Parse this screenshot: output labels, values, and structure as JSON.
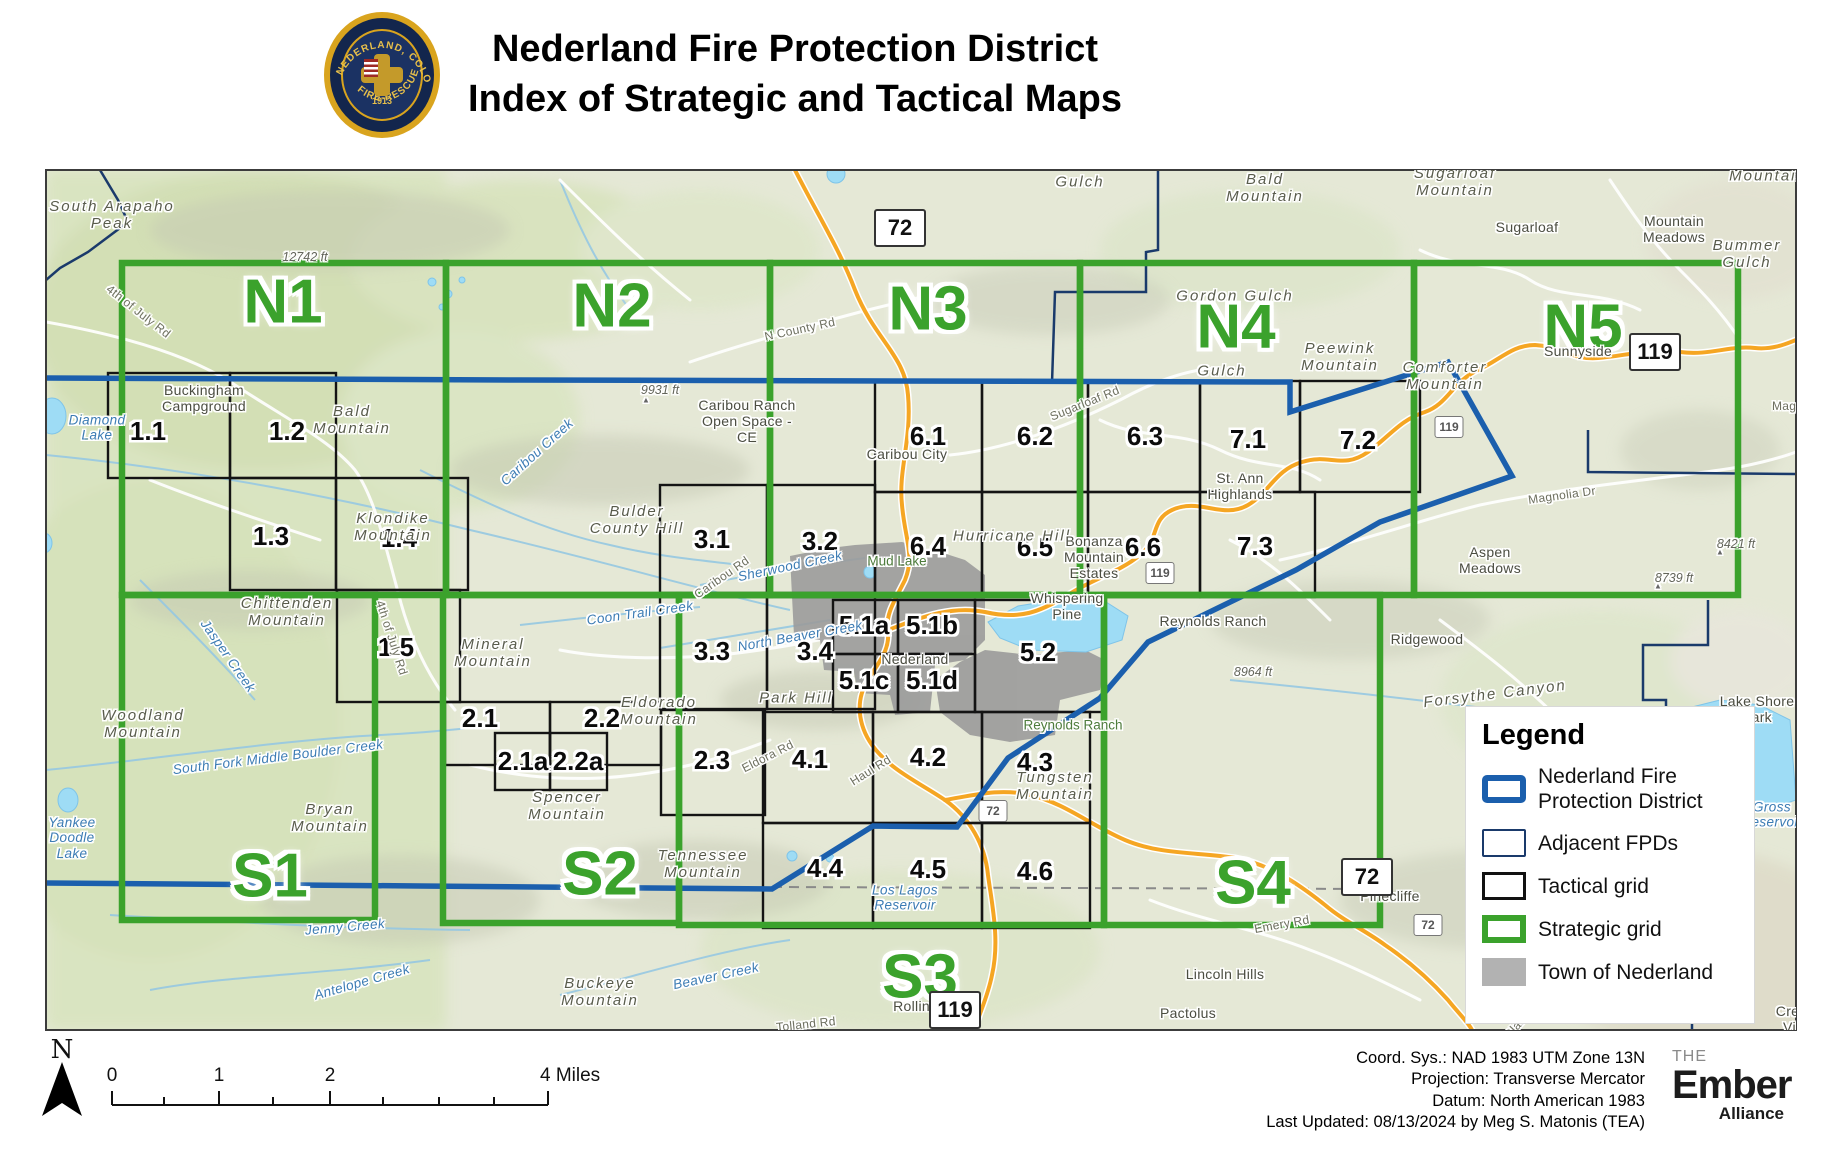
{
  "header": {
    "title_line1": "Nederland Fire Protection District",
    "title_line2": "Index of Strategic and Tactical Maps",
    "logo": {
      "ring_top": "NEDERLAND, COLORADO",
      "ring_bottom": "FIRE-RESCUE",
      "year": "1913"
    }
  },
  "map": {
    "strategic_cells": [
      {
        "id": "N1",
        "x1": 122,
        "y1": 263,
        "x2": 446,
        "y2": 595,
        "lx": 283,
        "ly": 303
      },
      {
        "id": "N2",
        "x1": 446,
        "y1": 263,
        "x2": 770,
        "y2": 595,
        "lx": 612,
        "ly": 307
      },
      {
        "id": "N3",
        "x1": 770,
        "y1": 263,
        "x2": 1080,
        "y2": 595,
        "lx": 928,
        "ly": 310
      },
      {
        "id": "N4",
        "x1": 1080,
        "y1": 263,
        "x2": 1414,
        "y2": 595,
        "lx": 1236,
        "ly": 328
      },
      {
        "id": "N5",
        "x1": 1414,
        "y1": 263,
        "x2": 1738,
        "y2": 595,
        "lx": 1583,
        "ly": 328
      },
      {
        "id": "S1",
        "x1": 122,
        "y1": 595,
        "x2": 375,
        "y2": 920,
        "lx": 270,
        "ly": 877
      },
      {
        "id": "S2",
        "x1": 443,
        "y1": 595,
        "x2": 679,
        "y2": 923,
        "lx": 600,
        "ly": 875
      },
      {
        "id": "S3",
        "x1": 679,
        "y1": 595,
        "x2": 1104,
        "y2": 925,
        "lx": 920,
        "ly": 978
      },
      {
        "id": "S4",
        "x1": 1104,
        "y1": 595,
        "x2": 1380,
        "y2": 925,
        "lx": 1253,
        "ly": 884
      }
    ],
    "tactical_cells": [
      {
        "id": "1.1",
        "x1": 108,
        "y1": 373,
        "x2": 230,
        "y2": 478,
        "lx": 148,
        "ly": 432
      },
      {
        "id": "1.2",
        "x1": 230,
        "y1": 373,
        "x2": 336,
        "y2": 478,
        "lx": 287,
        "ly": 432
      },
      {
        "id": "1.3",
        "x1": 230,
        "y1": 478,
        "x2": 336,
        "y2": 590,
        "lx": 271,
        "ly": 537
      },
      {
        "id": "1.4",
        "x1": 336,
        "y1": 478,
        "x2": 468,
        "y2": 590,
        "lx": 399,
        "ly": 539
      },
      {
        "id": "1.5",
        "x1": 337,
        "y1": 590,
        "x2": 460,
        "y2": 702,
        "lx": 396,
        "ly": 648
      },
      {
        "id": "2.1",
        "x1": 445,
        "y1": 702,
        "x2": 550,
        "y2": 765,
        "lx": 480,
        "ly": 719
      },
      {
        "id": "2.2",
        "x1": 550,
        "y1": 702,
        "x2": 661,
        "y2": 765,
        "lx": 602,
        "ly": 719
      },
      {
        "id": "2.1a",
        "x1": 495,
        "y1": 733,
        "x2": 550,
        "y2": 790,
        "lx": 523,
        "ly": 762
      },
      {
        "id": "2.2a",
        "x1": 550,
        "y1": 733,
        "x2": 607,
        "y2": 790,
        "lx": 578,
        "ly": 762
      },
      {
        "id": "2.3",
        "x1": 661,
        "y1": 710,
        "x2": 765,
        "y2": 815,
        "lx": 712,
        "ly": 761
      },
      {
        "id": "3.1",
        "x1": 660,
        "y1": 485,
        "x2": 767,
        "y2": 593,
        "lx": 712,
        "ly": 540
      },
      {
        "id": "3.2",
        "x1": 767,
        "y1": 485,
        "x2": 875,
        "y2": 593,
        "lx": 820,
        "ly": 542
      },
      {
        "id": "3.3",
        "x1": 660,
        "y1": 597,
        "x2": 767,
        "y2": 709,
        "lx": 712,
        "ly": 652
      },
      {
        "id": "3.4",
        "x1": 767,
        "y1": 597,
        "x2": 875,
        "y2": 709,
        "lx": 815,
        "ly": 652
      },
      {
        "id": "5.1a",
        "x1": 833,
        "y1": 600,
        "x2": 898,
        "y2": 654,
        "lx": 864,
        "ly": 626
      },
      {
        "id": "5.1b",
        "x1": 898,
        "y1": 600,
        "x2": 975,
        "y2": 654,
        "lx": 932,
        "ly": 626
      },
      {
        "id": "5.1c",
        "x1": 833,
        "y1": 654,
        "x2": 898,
        "y2": 712,
        "lx": 864,
        "ly": 681
      },
      {
        "id": "5.1d",
        "x1": 898,
        "y1": 654,
        "x2": 975,
        "y2": 712,
        "lx": 932,
        "ly": 681
      },
      {
        "id": "5.2",
        "x1": 975,
        "y1": 600,
        "x2": 1105,
        "y2": 712,
        "lx": 1038,
        "ly": 653
      },
      {
        "id": "4.1",
        "x1": 763,
        "y1": 712,
        "x2": 873,
        "y2": 823,
        "lx": 810,
        "ly": 760
      },
      {
        "id": "4.2",
        "x1": 873,
        "y1": 712,
        "x2": 982,
        "y2": 823,
        "lx": 928,
        "ly": 758
      },
      {
        "id": "4.3",
        "x1": 982,
        "y1": 712,
        "x2": 1090,
        "y2": 823,
        "lx": 1035,
        "ly": 763
      },
      {
        "id": "4.4",
        "x1": 763,
        "y1": 823,
        "x2": 873,
        "y2": 928,
        "lx": 825,
        "ly": 869
      },
      {
        "id": "4.5",
        "x1": 873,
        "y1": 823,
        "x2": 982,
        "y2": 928,
        "lx": 928,
        "ly": 870
      },
      {
        "id": "4.6",
        "x1": 982,
        "y1": 823,
        "x2": 1090,
        "y2": 928,
        "lx": 1035,
        "ly": 872
      },
      {
        "id": "6.1",
        "x1": 875,
        "y1": 381,
        "x2": 982,
        "y2": 492,
        "lx": 928,
        "ly": 437
      },
      {
        "id": "6.2",
        "x1": 982,
        "y1": 381,
        "x2": 1088,
        "y2": 492,
        "lx": 1035,
        "ly": 437
      },
      {
        "id": "6.3",
        "x1": 1088,
        "y1": 381,
        "x2": 1200,
        "y2": 492,
        "lx": 1145,
        "ly": 437
      },
      {
        "id": "7.1",
        "x1": 1200,
        "y1": 381,
        "x2": 1300,
        "y2": 492,
        "lx": 1248,
        "ly": 440
      },
      {
        "id": "7.2",
        "x1": 1300,
        "y1": 381,
        "x2": 1420,
        "y2": 492,
        "lx": 1358,
        "ly": 441
      },
      {
        "id": "6.4",
        "x1": 875,
        "y1": 492,
        "x2": 982,
        "y2": 597,
        "lx": 928,
        "ly": 547
      },
      {
        "id": "6.5",
        "x1": 982,
        "y1": 492,
        "x2": 1088,
        "y2": 597,
        "lx": 1035,
        "ly": 548
      },
      {
        "id": "6.6",
        "x1": 1088,
        "y1": 492,
        "x2": 1200,
        "y2": 597,
        "lx": 1143,
        "ly": 548
      },
      {
        "id": "7.3",
        "x1": 1200,
        "y1": 492,
        "x2": 1315,
        "y2": 597,
        "lx": 1255,
        "ly": 547
      }
    ],
    "labels": [
      {
        "t": "South Arapaho\nPeak",
        "x": 112,
        "y": 215,
        "c": "peak"
      },
      {
        "t": "12742 ft",
        "x": 305,
        "y": 257,
        "c": "elev"
      },
      {
        "t": "4th of July Rd",
        "x": 138,
        "y": 312,
        "c": "road",
        "r": 38
      },
      {
        "t": "Diamond\nLake",
        "x": 97,
        "y": 428,
        "c": "water"
      },
      {
        "t": "Buckingham\nCampground",
        "x": 204,
        "y": 399,
        "c": "place"
      },
      {
        "t": "Bald\nMountain",
        "x": 352,
        "y": 420,
        "c": "peak"
      },
      {
        "t": "Klondike\nMountain",
        "x": 393,
        "y": 527,
        "c": "peak"
      },
      {
        "t": "Chittenden\nMountain",
        "x": 287,
        "y": 612,
        "c": "peak"
      },
      {
        "t": "Jasper Creek",
        "x": 228,
        "y": 656,
        "c": "water",
        "r": 55
      },
      {
        "t": "Woodland\nMountain",
        "x": 143,
        "y": 724,
        "c": "peak"
      },
      {
        "t": "South Fork Middle Boulder Creek",
        "x": 278,
        "y": 757,
        "c": "water",
        "r": -7
      },
      {
        "t": "Bryan\nMountain",
        "x": 330,
        "y": 818,
        "c": "peak"
      },
      {
        "t": "Yankee\nDoodle\nLake",
        "x": 72,
        "y": 838,
        "c": "water"
      },
      {
        "t": "Jenny Creek",
        "x": 345,
        "y": 927,
        "c": "water",
        "r": -5
      },
      {
        "t": "Antelope Creek",
        "x": 362,
        "y": 982,
        "c": "water",
        "r": -16
      },
      {
        "t": "Mineral\nMountain",
        "x": 493,
        "y": 653,
        "c": "peak"
      },
      {
        "t": "Caribou Creek",
        "x": 537,
        "y": 452,
        "c": "water",
        "r": -42
      },
      {
        "t": "9931 ft",
        "x": 660,
        "y": 390,
        "c": "elev"
      },
      {
        "t": "▲",
        "x": 646,
        "y": 400,
        "c": "tri"
      },
      {
        "t": "Caribou Ranch\nOpen Space -\nCE",
        "x": 747,
        "y": 422,
        "c": "place"
      },
      {
        "t": "N County Rd",
        "x": 800,
        "y": 330,
        "c": "road",
        "r": -12
      },
      {
        "t": "Bulder\nCounty Hill",
        "x": 637,
        "y": 520,
        "c": "peak"
      },
      {
        "t": "Caribou Rd",
        "x": 722,
        "y": 578,
        "c": "road",
        "r": -35
      },
      {
        "t": "Sherwood Creek",
        "x": 790,
        "y": 566,
        "c": "water",
        "r": -12
      },
      {
        "t": "Coon Trail Creek",
        "x": 640,
        "y": 613,
        "c": "water",
        "r": -8
      },
      {
        "t": "Eldorado\nMountain",
        "x": 659,
        "y": 711,
        "c": "peak"
      },
      {
        "t": "Spencer\nMountain",
        "x": 567,
        "y": 806,
        "c": "peak"
      },
      {
        "t": "Tennessee\nMountain",
        "x": 703,
        "y": 864,
        "c": "peak"
      },
      {
        "t": "Buckeye\nMountain",
        "x": 600,
        "y": 992,
        "c": "peak"
      },
      {
        "t": "Beaver Creek",
        "x": 716,
        "y": 976,
        "c": "water",
        "r": -12
      },
      {
        "t": "Tolland Rd",
        "x": 806,
        "y": 1025,
        "c": "road",
        "r": -6
      },
      {
        "t": "Eldora Rd",
        "x": 768,
        "y": 757,
        "c": "road",
        "r": -27
      },
      {
        "t": "Haul Rd",
        "x": 871,
        "y": 771,
        "c": "road",
        "r": -32
      },
      {
        "t": "Park Hill",
        "x": 796,
        "y": 698,
        "c": "peak"
      },
      {
        "t": "North Beaver Creek",
        "x": 800,
        "y": 636,
        "c": "water",
        "r": -10
      },
      {
        "t": "Mud Lake",
        "x": 897,
        "y": 561,
        "c": "green"
      },
      {
        "t": "Caribou City",
        "x": 907,
        "y": 455,
        "c": "place"
      },
      {
        "t": "Nederland",
        "x": 915,
        "y": 660,
        "c": "place"
      },
      {
        "t": "Whispering\nPine",
        "x": 1067,
        "y": 607,
        "c": "place"
      },
      {
        "t": "Hurricane Hill",
        "x": 1012,
        "y": 536,
        "c": "peak"
      },
      {
        "t": "Bonanza\nMountain\nEstates",
        "x": 1094,
        "y": 558,
        "c": "place"
      },
      {
        "t": "Reynolds Ranch",
        "x": 1213,
        "y": 622,
        "c": "place"
      },
      {
        "t": "Reynolds Ranch",
        "x": 1073,
        "y": 725,
        "c": "green"
      },
      {
        "t": "Tungsten\nMountain",
        "x": 1055,
        "y": 786,
        "c": "peak"
      },
      {
        "t": "Los Lagos\nReservoir",
        "x": 905,
        "y": 898,
        "c": "water"
      },
      {
        "t": "Rollinsville",
        "x": 928,
        "y": 1007,
        "c": "place"
      },
      {
        "t": "Lincoln Hills",
        "x": 1225,
        "y": 975,
        "c": "place"
      },
      {
        "t": "Pactolus",
        "x": 1188,
        "y": 1014,
        "c": "place"
      },
      {
        "t": "Pinecliffe",
        "x": 1390,
        "y": 897,
        "c": "place"
      },
      {
        "t": "Emery Rd",
        "x": 1282,
        "y": 925,
        "c": "road",
        "r": -10
      },
      {
        "t": "Black Gulch",
        "x": 1530,
        "y": 1012,
        "c": "road",
        "r": -48
      },
      {
        "t": "Crescent\nVillage",
        "x": 1805,
        "y": 1020,
        "c": "place"
      },
      {
        "t": "Gulch",
        "x": 1080,
        "y": 182,
        "c": "peak"
      },
      {
        "t": "Bald\nMountain",
        "x": 1265,
        "y": 188,
        "c": "peak"
      },
      {
        "t": "Gordon Gulch",
        "x": 1235,
        "y": 296,
        "c": "peak"
      },
      {
        "t": "Gulch",
        "x": 1222,
        "y": 371,
        "c": "peak"
      },
      {
        "t": "Peewink\nMountain",
        "x": 1340,
        "y": 357,
        "c": "peak"
      },
      {
        "t": "Sugarloaf\nMountain",
        "x": 1455,
        "y": 182,
        "c": "peak"
      },
      {
        "t": "Sugarloaf",
        "x": 1527,
        "y": 228,
        "c": "place"
      },
      {
        "t": "Mountain\nMeadows",
        "x": 1674,
        "y": 230,
        "c": "place"
      },
      {
        "t": "Bummer\nGulch",
        "x": 1747,
        "y": 254,
        "c": "peak"
      },
      {
        "t": "Mountain",
        "x": 1768,
        "y": 176,
        "c": "peak"
      },
      {
        "t": "Comforter\nMountain",
        "x": 1445,
        "y": 376,
        "c": "peak"
      },
      {
        "t": "Sunnyside",
        "x": 1578,
        "y": 352,
        "c": "place"
      },
      {
        "t": "St. Ann\nHighlands",
        "x": 1240,
        "y": 487,
        "c": "place"
      },
      {
        "t": "Sugarloaf Rd",
        "x": 1085,
        "y": 404,
        "c": "road",
        "r": -22
      },
      {
        "t": "Magnolia Dr",
        "x": 1562,
        "y": 496,
        "c": "road",
        "r": -8
      },
      {
        "t": "Magnolia Dr",
        "x": 1806,
        "y": 407,
        "c": "road"
      },
      {
        "t": "Aspen\nMeadows",
        "x": 1490,
        "y": 561,
        "c": "place"
      },
      {
        "t": "Ridgewood",
        "x": 1427,
        "y": 640,
        "c": "place"
      },
      {
        "t": "8964 ft",
        "x": 1253,
        "y": 672,
        "c": "elev"
      },
      {
        "t": "8421 ft",
        "x": 1736,
        "y": 544,
        "c": "elev"
      },
      {
        "t": "▲",
        "x": 1720,
        "y": 552,
        "c": "tri"
      },
      {
        "t": "8739 ft",
        "x": 1674,
        "y": 578,
        "c": "elev"
      },
      {
        "t": "▲",
        "x": 1658,
        "y": 586,
        "c": "tri"
      },
      {
        "t": "Forsythe Canyon",
        "x": 1495,
        "y": 694,
        "c": "peak",
        "r": -7
      },
      {
        "t": "Lake Shore\nPark",
        "x": 1757,
        "y": 710,
        "c": "place"
      },
      {
        "t": "Gross\nReservoir",
        "x": 1772,
        "y": 815,
        "c": "water"
      },
      {
        "t": "4th of July Rd",
        "x": 391,
        "y": 638,
        "c": "road",
        "r": 72
      }
    ],
    "shields": [
      {
        "n": "72",
        "x": 900,
        "y": 228,
        "s": "lg"
      },
      {
        "n": "119",
        "x": 1655,
        "y": 352,
        "s": "lg"
      },
      {
        "n": "119",
        "x": 1449,
        "y": 427,
        "s": "sm"
      },
      {
        "n": "119",
        "x": 1160,
        "y": 573,
        "s": "sm"
      },
      {
        "n": "72",
        "x": 993,
        "y": 811,
        "s": "sm"
      },
      {
        "n": "72",
        "x": 1367,
        "y": 877,
        "s": "lg"
      },
      {
        "n": "72",
        "x": 1428,
        "y": 925,
        "s": "sm"
      },
      {
        "n": "119",
        "x": 955,
        "y": 1010,
        "s": "lg"
      }
    ]
  },
  "legend": {
    "title": "Legend",
    "items": [
      {
        "key": "district",
        "label": "Nederland Fire Protection District"
      },
      {
        "key": "adjacent",
        "label": "Adjacent FPDs"
      },
      {
        "key": "tactical",
        "label": "Tactical grid"
      },
      {
        "key": "strategic",
        "label": "Strategic grid"
      },
      {
        "key": "town",
        "label": "Town of Nederland"
      }
    ]
  },
  "footer": {
    "north_label": "N",
    "scalebar": {
      "y": 1105,
      "ticks": [
        {
          "x": 112,
          "l": "0"
        },
        {
          "x": 219,
          "l": "1"
        },
        {
          "x": 330,
          "l": "2"
        },
        {
          "x": 548,
          "l": "4 Miles"
        }
      ],
      "minor": [
        164,
        273,
        383,
        439,
        494
      ]
    },
    "credits": [
      "Coord. Sys.: NAD 1983 UTM Zone 13N",
      "Projection: Transverse Mercator",
      "Datum: North American 1983",
      "Last Updated: 08/13/2024 by Meg S. Matonis (TEA)"
    ],
    "ember": {
      "the": "THE",
      "name": "Ember",
      "sub": "Alliance"
    }
  },
  "colors": {
    "strategic_green": "#3ba22c",
    "district_blue": "#1b5fad",
    "adjacent_navy": "#1a3a6b",
    "tactical_black": "#141414",
    "town_gray": "#b2b2b2",
    "highway_orange": "#f5a623",
    "water_blue": "#9edcf5"
  }
}
